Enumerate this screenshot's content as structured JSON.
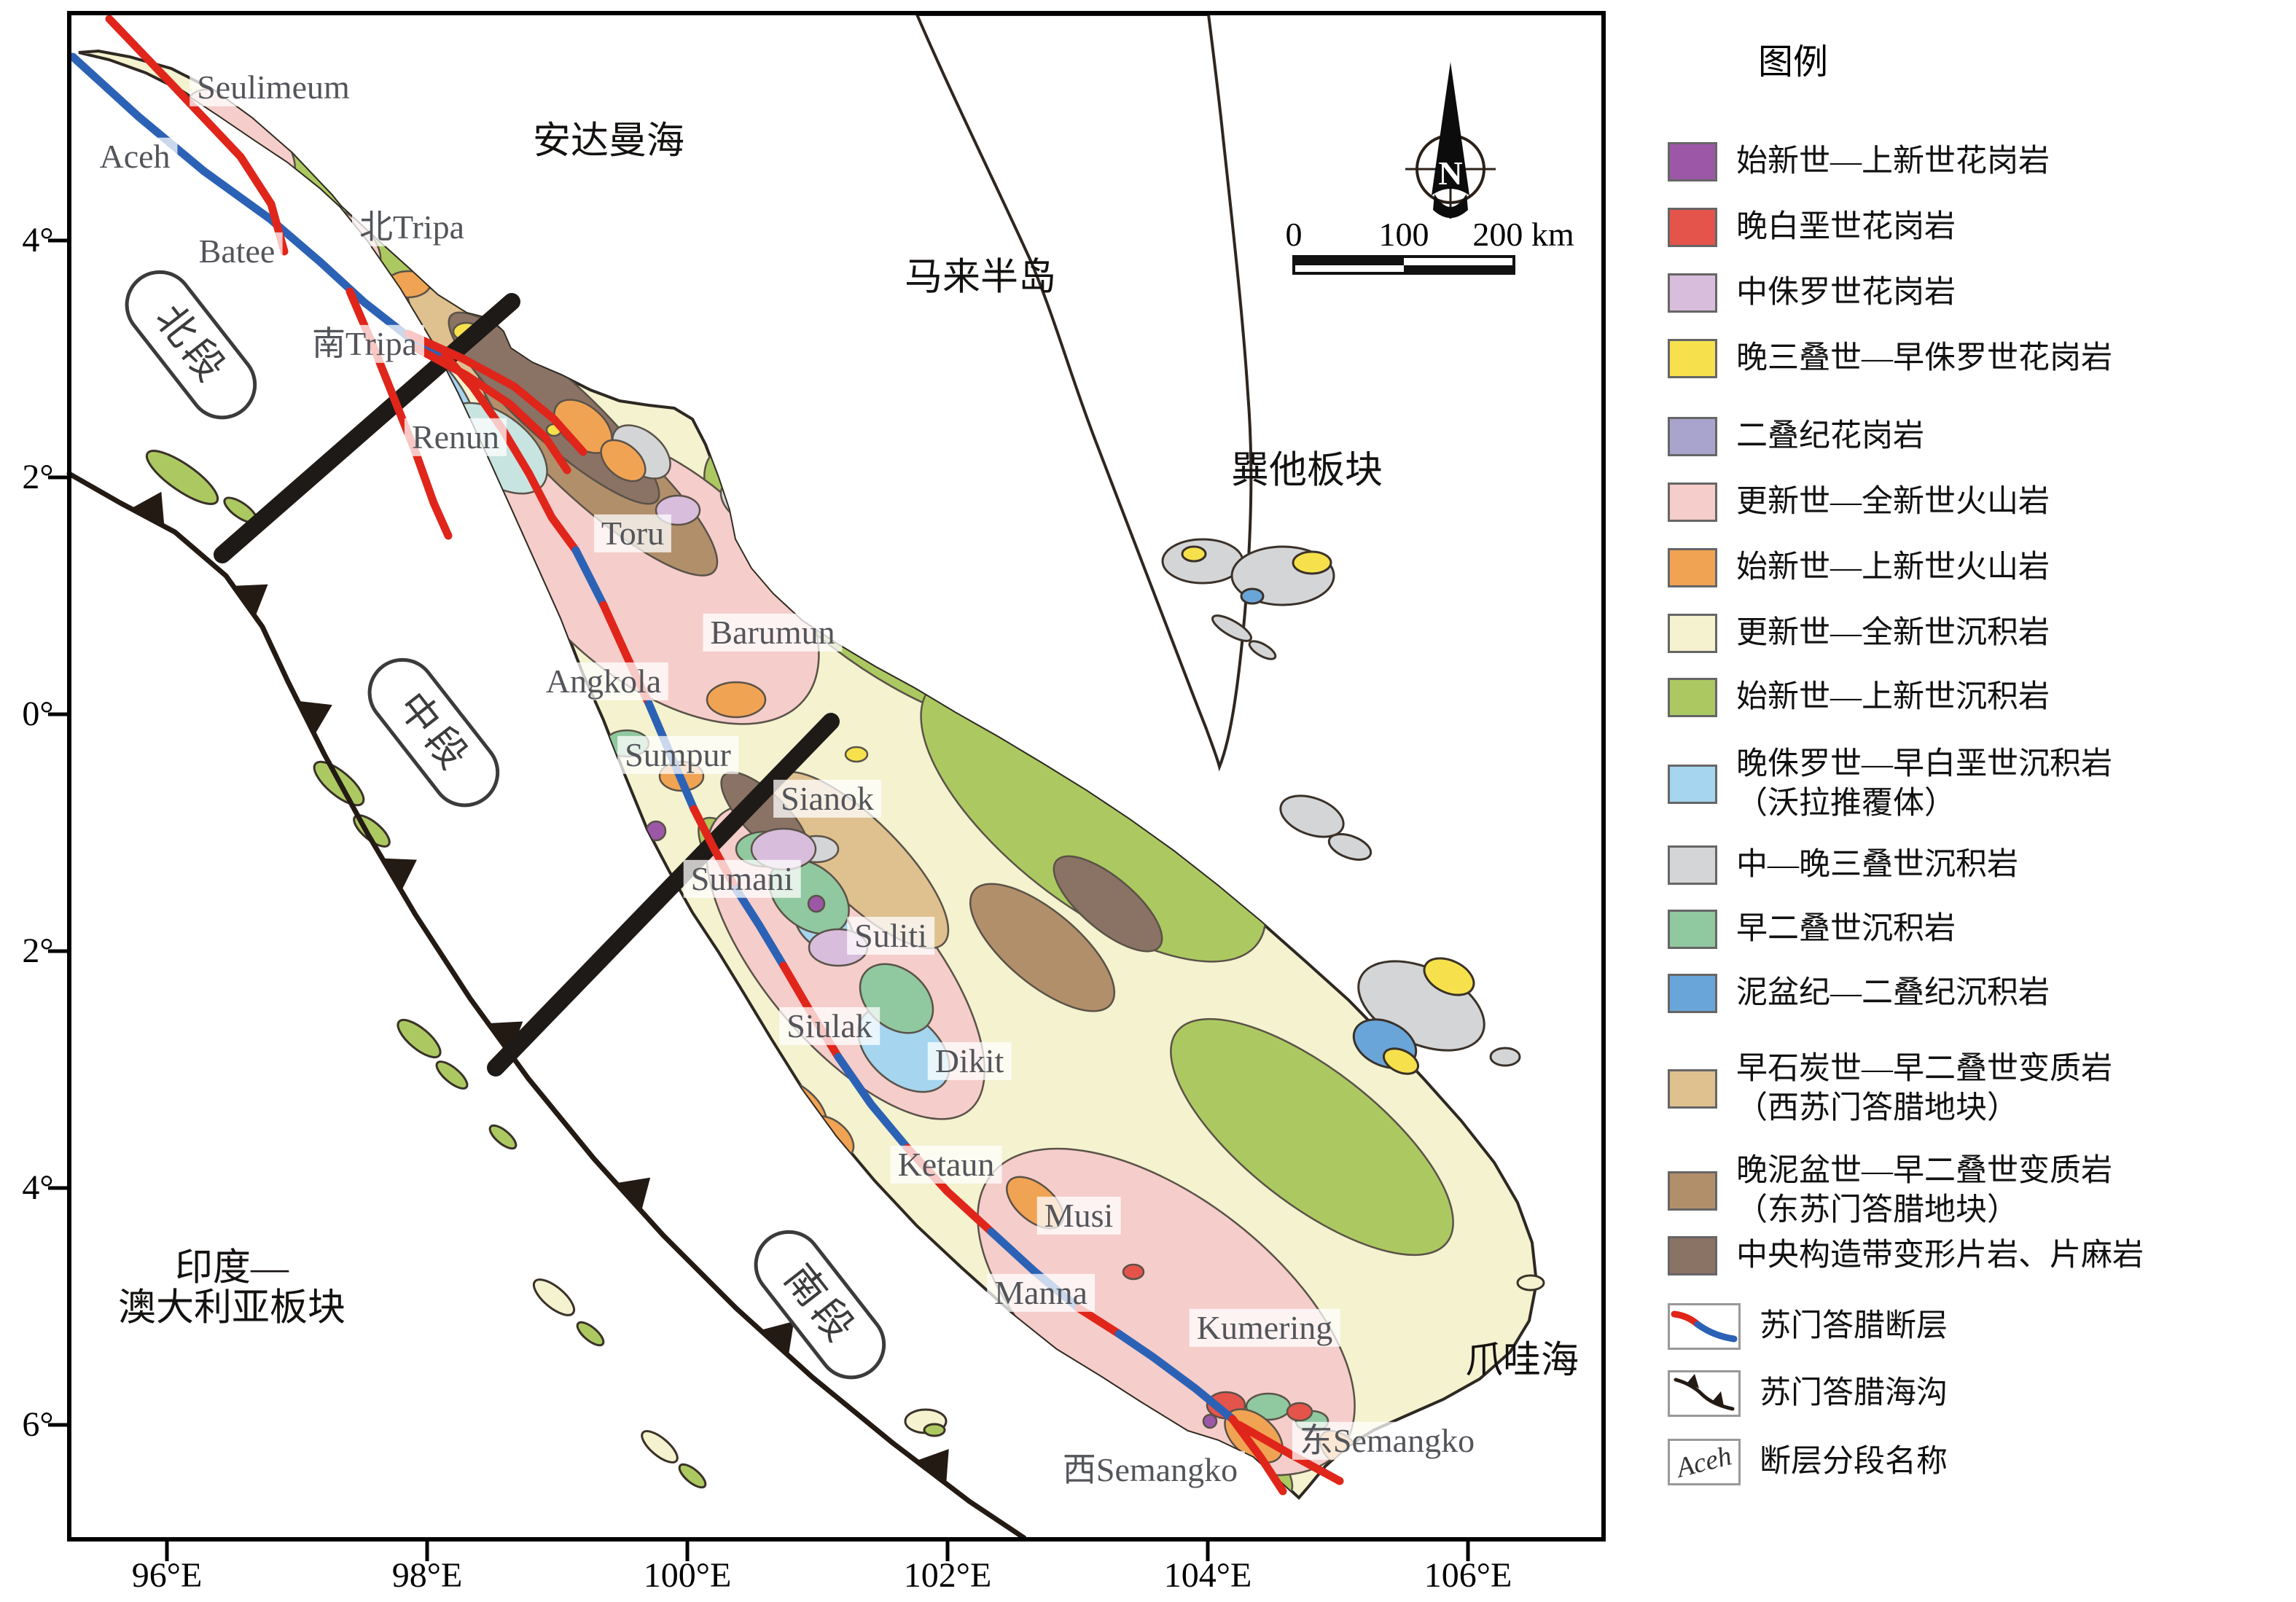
{
  "colors": {
    "fault_red": "#E0251B",
    "fault_blue": "#2C62B5",
    "trench": "#241a14",
    "section_line": "#1e1a17",
    "island_base": "#F4F2CF",
    "outline": "#3a3128"
  },
  "legend": {
    "title": "图例",
    "items": [
      {
        "type": "color",
        "color": "#9C57A6",
        "label": "始新世—上新世花岗岩"
      },
      {
        "type": "color",
        "color": "#E4544B",
        "label": "晚白垩世花岗岩"
      },
      {
        "type": "color",
        "color": "#D9BDDC",
        "label": "中侏罗世花岗岩"
      },
      {
        "type": "color",
        "color": "#F6E14C",
        "label": "晚三叠世—早侏罗世花岗岩"
      },
      {
        "type": "color",
        "color": "#A8A4CD",
        "label": "二叠纪花岗岩"
      },
      {
        "type": "color",
        "color": "#F5CDCA",
        "label": "更新世—全新世火山岩"
      },
      {
        "type": "color",
        "color": "#F0A353",
        "label": "始新世—上新世火山岩"
      },
      {
        "type": "color",
        "color": "#F4F2CF",
        "label": "更新世—全新世沉积岩"
      },
      {
        "type": "color",
        "color": "#ACC961",
        "label": "始新世—上新世沉积岩"
      },
      {
        "type": "color",
        "color": "#A5D5EF",
        "label": "晚侏罗世—早白垩世沉积岩",
        "label2": "（沃拉推覆体）"
      },
      {
        "type": "color",
        "color": "#D4D5D7",
        "label": "中—晚三叠世沉积岩"
      },
      {
        "type": "color",
        "color": "#90C8A0",
        "label": "早二叠世沉积岩"
      },
      {
        "type": "color",
        "color": "#69A5D9",
        "label": "泥盆纪—二叠纪沉积岩"
      },
      {
        "type": "color",
        "color": "#DFC08F",
        "label": "早石炭世—早二叠世变质岩",
        "label2": "（西苏门答腊地块）"
      },
      {
        "type": "color",
        "color": "#B28F6B",
        "label": "晚泥盆世—早二叠世变质岩",
        "label2": "（东苏门答腊地块）"
      },
      {
        "type": "color",
        "color": "#8A7265",
        "label": "中央构造带变形片岩、片麻岩"
      },
      {
        "type": "fault",
        "label": "苏门答腊断层"
      },
      {
        "type": "trench",
        "label": "苏门答腊海沟"
      },
      {
        "type": "name",
        "symbol": "Aceh",
        "label": "断层分段名称"
      }
    ],
    "row_tops": [
      195,
      285,
      375,
      465,
      572,
      662,
      752,
      842,
      930,
      1022,
      1160,
      1248,
      1336,
      1440,
      1580,
      1696,
      1788,
      1880,
      1974
    ]
  },
  "axes": {
    "x_ticks": [
      {
        "label": "96°E",
        "x": 229
      },
      {
        "label": "98°E",
        "x": 586
      },
      {
        "label": "100°E",
        "x": 943
      },
      {
        "label": "102°E",
        "x": 1300
      },
      {
        "label": "104°E",
        "x": 1657
      },
      {
        "label": "106°E",
        "x": 2014
      }
    ],
    "y_ticks": [
      {
        "label": "4°",
        "y": 330
      },
      {
        "label": "2°",
        "y": 655
      },
      {
        "label": "0°",
        "y": 980
      },
      {
        "label": "2°",
        "y": 1305
      },
      {
        "label": "4°",
        "y": 1630
      },
      {
        "label": "6°",
        "y": 1955
      }
    ]
  },
  "map": {
    "fault_segments": [
      {
        "name": "Seulimeum",
        "x": 375,
        "y": 120
      },
      {
        "name": "Aceh",
        "x": 185,
        "y": 215
      },
      {
        "name": "Batee",
        "x": 325,
        "y": 345
      },
      {
        "name": "北Tripa",
        "x": 565,
        "y": 312
      },
      {
        "name": "南Tripa",
        "x": 500,
        "y": 472
      },
      {
        "name": "Renun",
        "x": 625,
        "y": 600
      },
      {
        "name": "Toru",
        "x": 868,
        "y": 732
      },
      {
        "name": "Barumun",
        "x": 1060,
        "y": 868
      },
      {
        "name": "Angkola",
        "x": 828,
        "y": 935
      },
      {
        "name": "Sumpur",
        "x": 930,
        "y": 1036
      },
      {
        "name": "Sianok",
        "x": 1135,
        "y": 1096
      },
      {
        "name": "Sumani",
        "x": 1018,
        "y": 1206
      },
      {
        "name": "Suliti",
        "x": 1222,
        "y": 1284
      },
      {
        "name": "Siulak",
        "x": 1138,
        "y": 1408
      },
      {
        "name": "Dikit",
        "x": 1330,
        "y": 1456
      },
      {
        "name": "Ketaun",
        "x": 1298,
        "y": 1598
      },
      {
        "name": "Musi",
        "x": 1480,
        "y": 1668
      },
      {
        "name": "Manna",
        "x": 1428,
        "y": 1774
      },
      {
        "name": "Kumering",
        "x": 1735,
        "y": 1822
      },
      {
        "name": "西Semangko",
        "x": 1578,
        "y": 2017
      },
      {
        "name": "东Semangko",
        "x": 1903,
        "y": 1977
      }
    ],
    "regions": [
      {
        "lines": [
          "安达曼海"
        ],
        "x": 835,
        "y": 195
      },
      {
        "lines": [
          "马来半岛"
        ],
        "x": 1345,
        "y": 382
      },
      {
        "lines": [
          "巽他板块"
        ],
        "x": 1793,
        "y": 647
      },
      {
        "lines": [
          "爪哇海"
        ],
        "x": 2088,
        "y": 1868
      },
      {
        "lines": [
          "印度—",
          "澳大利亚板块"
        ],
        "x": 318,
        "y": 1768
      }
    ],
    "zones": [
      {
        "name": "北段",
        "x": 262,
        "y": 473,
        "rot": 52
      },
      {
        "name": "中段",
        "x": 595,
        "y": 1005,
        "rot": 52
      },
      {
        "name": "南段",
        "x": 1125,
        "y": 1790,
        "rot": 52
      }
    ]
  },
  "north": {
    "label": "N"
  },
  "scalebar": {
    "labels": [
      {
        "text": "0",
        "x": 1775
      },
      {
        "text": "100",
        "x": 1926
      },
      {
        "text": "200 km",
        "x": 2090
      }
    ]
  }
}
